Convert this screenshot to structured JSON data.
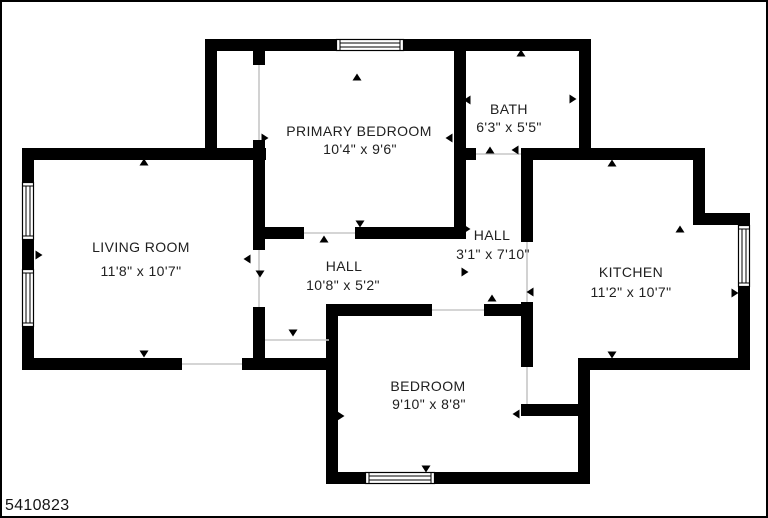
{
  "plan": {
    "canvas": {
      "width": 768,
      "height": 518
    },
    "colors": {
      "background": "#ffffff",
      "wall": "#000000",
      "opening": "#c7c7c7",
      "window_frame": "#000000",
      "text": "#202020",
      "border": "#000000"
    },
    "listing_id": "5410823",
    "rooms": [
      {
        "name": "LIVING ROOM",
        "dims": "11'8\" x 10'7\"",
        "name_x": 139,
        "name_y": 245,
        "dims_x": 139,
        "dims_y": 269
      },
      {
        "name": "PRIMARY BEDROOM",
        "dims": "10'4\" x 9'6\"",
        "name_x": 357,
        "name_y": 129,
        "dims_x": 358,
        "dims_y": 147
      },
      {
        "name": "BATH",
        "dims": "6'3\" x 5'5\"",
        "name_x": 507,
        "name_y": 107,
        "dims_x": 507,
        "dims_y": 125
      },
      {
        "name": "HALL",
        "dims": "3'1\" x 7'10\"",
        "name_x": 490,
        "name_y": 233,
        "dims_x": 491,
        "dims_y": 252
      },
      {
        "name": "HALL",
        "dims": "10'8\" x 5'2\"",
        "name_x": 342,
        "name_y": 264,
        "dims_x": 341,
        "dims_y": 283
      },
      {
        "name": "KITCHEN",
        "dims": "11'2\" x 10'7\"",
        "name_x": 629,
        "name_y": 270,
        "dims_x": 629,
        "dims_y": 290
      },
      {
        "name": "BEDROOM",
        "dims": "9'10\" x 8'8\"",
        "name_x": 426,
        "name_y": 384,
        "dims_x": 427,
        "dims_y": 402
      }
    ],
    "walls": [
      [
        203,
        37,
        131,
        12
      ],
      [
        402,
        37,
        187,
        12
      ],
      [
        203,
        37,
        12,
        116
      ],
      [
        20,
        146,
        244,
        12
      ],
      [
        20,
        146,
        12,
        34
      ],
      [
        20,
        238,
        12,
        29
      ],
      [
        20,
        325,
        12,
        43
      ],
      [
        20,
        356,
        160,
        12
      ],
      [
        240,
        356,
        96,
        12
      ],
      [
        251,
        47,
        12,
        16
      ],
      [
        251,
        138,
        12,
        110
      ],
      [
        251,
        305,
        12,
        63
      ],
      [
        251,
        225,
        51,
        12
      ],
      [
        353,
        225,
        107,
        12
      ],
      [
        452,
        47,
        12,
        190
      ],
      [
        464,
        146,
        10,
        12
      ],
      [
        577,
        37,
        12,
        121
      ],
      [
        519,
        146,
        184,
        12
      ],
      [
        519,
        146,
        12,
        94
      ],
      [
        519,
        300,
        12,
        65
      ],
      [
        691,
        146,
        12,
        77
      ],
      [
        691,
        211,
        57,
        12
      ],
      [
        736,
        211,
        12,
        12
      ],
      [
        736,
        285,
        12,
        83
      ],
      [
        519,
        402,
        69,
        12
      ],
      [
        576,
        356,
        172,
        12
      ],
      [
        576,
        356,
        12,
        126
      ],
      [
        327,
        302,
        103,
        12
      ],
      [
        482,
        302,
        45,
        12
      ],
      [
        324,
        302,
        12,
        180
      ],
      [
        324,
        470,
        39,
        12
      ],
      [
        433,
        470,
        155,
        12
      ]
    ],
    "windows": [
      {
        "x": 334,
        "y": 37,
        "w": 68,
        "h": 12,
        "o": "h"
      },
      {
        "x": 20,
        "y": 180,
        "w": 12,
        "h": 58,
        "o": "v"
      },
      {
        "x": 20,
        "y": 267,
        "w": 12,
        "h": 58,
        "o": "v"
      },
      {
        "x": 736,
        "y": 223,
        "w": 12,
        "h": 62,
        "o": "v"
      },
      {
        "x": 363,
        "y": 470,
        "w": 70,
        "h": 12,
        "o": "h"
      }
    ],
    "openings": [
      [
        263,
        338,
        327,
        338
      ],
      [
        474,
        152,
        519,
        152
      ],
      [
        525,
        240,
        525,
        300
      ],
      [
        257,
        248,
        257,
        305
      ],
      [
        180,
        362,
        240,
        362
      ],
      [
        430,
        308,
        482,
        308
      ],
      [
        302,
        231,
        353,
        231
      ],
      [
        257,
        63,
        257,
        138
      ],
      [
        525,
        365,
        525,
        402
      ]
    ],
    "arrows": [
      {
        "x": 142,
        "y": 161,
        "d": "up"
      },
      {
        "x": 355,
        "y": 76,
        "d": "up"
      },
      {
        "x": 519,
        "y": 52,
        "d": "up"
      },
      {
        "x": 570,
        "y": 97,
        "d": "right"
      },
      {
        "x": 466,
        "y": 98,
        "d": "left"
      },
      {
        "x": 448,
        "y": 136,
        "d": "left"
      },
      {
        "x": 262,
        "y": 136,
        "d": "right"
      },
      {
        "x": 36,
        "y": 253,
        "d": "right"
      },
      {
        "x": 246,
        "y": 257,
        "d": "left"
      },
      {
        "x": 258,
        "y": 271,
        "d": "down"
      },
      {
        "x": 291,
        "y": 330,
        "d": "down"
      },
      {
        "x": 322,
        "y": 238,
        "d": "up"
      },
      {
        "x": 358,
        "y": 221,
        "d": "down"
      },
      {
        "x": 464,
        "y": 227,
        "d": "right"
      },
      {
        "x": 462,
        "y": 270,
        "d": "right"
      },
      {
        "x": 488,
        "y": 149,
        "d": "up"
      },
      {
        "x": 514,
        "y": 148,
        "d": "left"
      },
      {
        "x": 529,
        "y": 290,
        "d": "left"
      },
      {
        "x": 490,
        "y": 297,
        "d": "up"
      },
      {
        "x": 424,
        "y": 308,
        "d": "down"
      },
      {
        "x": 610,
        "y": 162,
        "d": "up"
      },
      {
        "x": 678,
        "y": 228,
        "d": "up"
      },
      {
        "x": 610,
        "y": 352,
        "d": "down"
      },
      {
        "x": 142,
        "y": 351,
        "d": "down"
      },
      {
        "x": 424,
        "y": 466,
        "d": "down"
      },
      {
        "x": 732,
        "y": 291,
        "d": "right"
      },
      {
        "x": 338,
        "y": 414,
        "d": "right"
      },
      {
        "x": 515,
        "y": 412,
        "d": "left"
      }
    ]
  }
}
